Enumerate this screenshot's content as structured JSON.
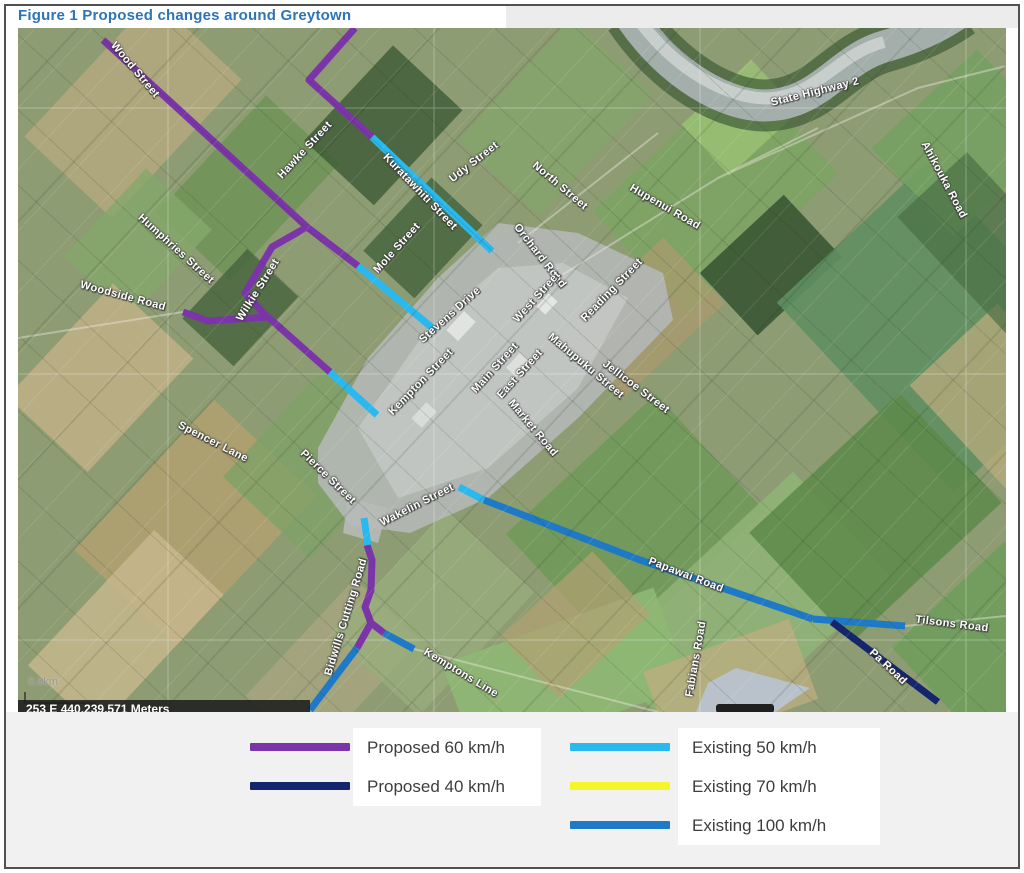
{
  "figure": {
    "title": "Figure 1 Proposed changes around Greytown"
  },
  "map": {
    "place": "Greytown",
    "scale_text": "0.6km",
    "coordinate_bar": "253 E 440,239,571 Meters",
    "route_colors": {
      "proposed_60": "#7b35a8",
      "proposed_40": "#15256d",
      "existing_50": "#29b9ef",
      "existing_70": "#f5f52b",
      "existing_100": "#1e7ac6"
    },
    "street_labels": [
      {
        "text": "Wood Street",
        "x": 117,
        "y": 42,
        "rot": 50
      },
      {
        "text": "Hawke Street",
        "x": 287,
        "y": 122,
        "rot": -47
      },
      {
        "text": "Kuratawhiti Street",
        "x": 402,
        "y": 164,
        "rot": 46
      },
      {
        "text": "Udy Street",
        "x": 456,
        "y": 134,
        "rot": -38
      },
      {
        "text": "North Street",
        "x": 542,
        "y": 158,
        "rot": 40
      },
      {
        "text": "Orchard Road",
        "x": 522,
        "y": 228,
        "rot": 52
      },
      {
        "text": "Hupenui Road",
        "x": 647,
        "y": 179,
        "rot": 30
      },
      {
        "text": "State Highway 2",
        "x": 797,
        "y": 64,
        "rot": -14
      },
      {
        "text": "Ahikouka Road",
        "x": 926,
        "y": 152,
        "rot": 62
      },
      {
        "text": "Humphries Street",
        "x": 158,
        "y": 221,
        "rot": 42
      },
      {
        "text": "Wilkie Street",
        "x": 240,
        "y": 262,
        "rot": -58
      },
      {
        "text": "Woodside Road",
        "x": 105,
        "y": 268,
        "rot": 15
      },
      {
        "text": "Mole Street",
        "x": 379,
        "y": 220,
        "rot": -48
      },
      {
        "text": "Stevens Drive",
        "x": 432,
        "y": 287,
        "rot": -42
      },
      {
        "text": "West Street",
        "x": 519,
        "y": 269,
        "rot": -48
      },
      {
        "text": "Reading Street",
        "x": 594,
        "y": 262,
        "rot": -46
      },
      {
        "text": "Main Street",
        "x": 477,
        "y": 340,
        "rot": -48
      },
      {
        "text": "East Street",
        "x": 502,
        "y": 346,
        "rot": -48
      },
      {
        "text": "Mahupuku Street",
        "x": 568,
        "y": 338,
        "rot": 40
      },
      {
        "text": "Jellicoe Street",
        "x": 618,
        "y": 359,
        "rot": 37
      },
      {
        "text": "Kempton Street",
        "x": 403,
        "y": 354,
        "rot": -46
      },
      {
        "text": "Market Road",
        "x": 515,
        "y": 400,
        "rot": 50
      },
      {
        "text": "Spencer Lane",
        "x": 195,
        "y": 414,
        "rot": 27
      },
      {
        "text": "Pierce Street",
        "x": 310,
        "y": 449,
        "rot": 44
      },
      {
        "text": "Wakelin Street",
        "x": 399,
        "y": 477,
        "rot": -27
      },
      {
        "text": "Bidwills Cutting Road",
        "x": 328,
        "y": 589,
        "rot": -73
      },
      {
        "text": "Kemptons Line",
        "x": 443,
        "y": 645,
        "rot": 31
      },
      {
        "text": "Papawai Road",
        "x": 668,
        "y": 547,
        "rot": 21
      },
      {
        "text": "Fabians Road",
        "x": 678,
        "y": 631,
        "rot": -80
      },
      {
        "text": "Tilsons Road",
        "x": 934,
        "y": 596,
        "rot": 7
      },
      {
        "text": "Pa Road",
        "x": 870,
        "y": 639,
        "rot": 43
      }
    ],
    "routes": [
      {
        "name": "Hawke Street north branch",
        "category": "proposed_60",
        "points": [
          [
            337,
            0
          ],
          [
            291,
            52
          ],
          [
            354,
            109
          ]
        ]
      },
      {
        "name": "Wood Street",
        "category": "proposed_60",
        "points": [
          [
            85,
            12
          ],
          [
            289,
            199
          ],
          [
            340,
            238
          ]
        ]
      },
      {
        "name": "Wilkie Street",
        "category": "proposed_60",
        "points": [
          [
            289,
            199
          ],
          [
            254,
            219
          ],
          [
            227,
            265
          ],
          [
            250,
            290
          ]
        ]
      },
      {
        "name": "Woodside Road",
        "category": "proposed_60",
        "points": [
          [
            165,
            284
          ],
          [
            190,
            293
          ],
          [
            250,
            289
          ]
        ]
      },
      {
        "name": "Wilkie Street south",
        "category": "proposed_60",
        "points": [
          [
            250,
            289
          ],
          [
            312,
            344
          ]
        ]
      },
      {
        "name": "Bidwills Cutting Road",
        "category": "proposed_60",
        "points": [
          [
            349,
            517
          ],
          [
            354,
            532
          ],
          [
            353,
            562
          ],
          [
            347,
            579
          ],
          [
            353,
            595
          ]
        ]
      },
      {
        "name": "Bidwills junction west",
        "category": "proposed_60",
        "points": [
          [
            353,
            595
          ],
          [
            339,
            620
          ]
        ]
      },
      {
        "name": "Bidwills junction east",
        "category": "proposed_60",
        "points": [
          [
            353,
            595
          ],
          [
            366,
            605
          ]
        ]
      },
      {
        "name": "Kuratawhiti Street",
        "category": "existing_50",
        "points": [
          [
            354,
            109
          ],
          [
            474,
            223
          ]
        ]
      },
      {
        "name": "Mole Street approach",
        "category": "existing_50",
        "points": [
          [
            340,
            238
          ],
          [
            418,
            303
          ]
        ]
      },
      {
        "name": "Pierce Street approach",
        "category": "existing_50",
        "points": [
          [
            312,
            344
          ],
          [
            359,
            387
          ]
        ]
      },
      {
        "name": "South town stub",
        "category": "existing_50",
        "points": [
          [
            346,
            490
          ],
          [
            350,
            517
          ]
        ]
      },
      {
        "name": "Papawai Road start",
        "category": "existing_50",
        "points": [
          [
            441,
            459
          ],
          [
            466,
            472
          ]
        ]
      },
      {
        "name": "Papawai Road",
        "category": "existing_100",
        "points": [
          [
            466,
            472
          ],
          [
            622,
            532
          ],
          [
            795,
            591
          ]
        ]
      },
      {
        "name": "Tilsons Road",
        "category": "existing_100",
        "points": [
          [
            795,
            591
          ],
          [
            887,
            598
          ]
        ]
      },
      {
        "name": "Bidwills Cutting Road south",
        "category": "existing_100",
        "points": [
          [
            339,
            620
          ],
          [
            292,
            682
          ]
        ]
      },
      {
        "name": "Kemptons Line",
        "category": "existing_100",
        "points": [
          [
            366,
            605
          ],
          [
            396,
            621
          ]
        ]
      },
      {
        "name": "Pa Road",
        "category": "proposed_40",
        "points": [
          [
            814,
            594
          ],
          [
            920,
            674
          ]
        ]
      }
    ]
  },
  "legend": {
    "columns": [
      {
        "items": [
          {
            "label": "Proposed 60 km/h",
            "category": "proposed_60",
            "color": "#7b35a8"
          },
          {
            "label": "Proposed 40 km/h",
            "category": "proposed_40",
            "color": "#15256d"
          }
        ]
      },
      {
        "items": [
          {
            "label": "Existing 50 km/h",
            "category": "existing_50",
            "color": "#29b9ef"
          },
          {
            "label": "Existing 70 km/h",
            "category": "existing_70",
            "color": "#f5f52b"
          },
          {
            "label": "Existing 100 km/h",
            "category": "existing_100",
            "color": "#1e7ac6"
          }
        ]
      }
    ]
  }
}
